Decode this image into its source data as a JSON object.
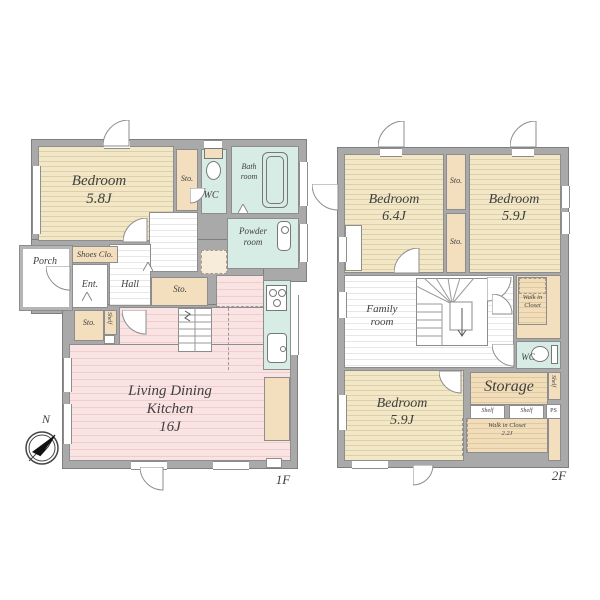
{
  "compass": {
    "north_label": "N"
  },
  "floor1": {
    "floor_label": "1F",
    "bedroom": {
      "name": "Bedroom",
      "size": "5.8J"
    },
    "sto_top": "Sto.",
    "wc": "WC",
    "bathroom": "Bath room",
    "powder_room": "Powder room",
    "shoes_closet": "Shoes Clo.",
    "porch": "Porch",
    "entrance": "Ent.",
    "hall": "Hall",
    "sto_center": "Sto.",
    "sto_left": "Sto.",
    "shelf_left": "Shelf",
    "ldk": {
      "name": "Living Dining Kitchen",
      "size": "16J"
    }
  },
  "floor2": {
    "floor_label": "2F",
    "bedroom_64": {
      "name": "Bedroom",
      "size": "6.4J"
    },
    "sto_upper": "Sto.",
    "sto_lower": "Sto.",
    "bedroom_59_top": {
      "name": "Bedroom",
      "size": "5.9J"
    },
    "walk_in_closet_top": "Walk in Closet",
    "family_room": "Family room",
    "wc": "WC",
    "storage": "Storage",
    "shelf_right": "Shelf",
    "shelf_box1": "Shelf",
    "shelf_box2": "Shelf",
    "ps": "PS",
    "bedroom_59_bottom": {
      "name": "Bedroom",
      "size": "5.9J"
    },
    "walk_in_closet_bottom": {
      "name": "Walk in Closet",
      "size": "2.2J"
    }
  },
  "colors": {
    "wall": "#a9a9a9",
    "bedroom_fill": "#f2e7c6",
    "storage_fill": "#f3dfbd",
    "ldk_fill": "#f9e3e3",
    "wet_area_fill": "#d8ece6"
  }
}
